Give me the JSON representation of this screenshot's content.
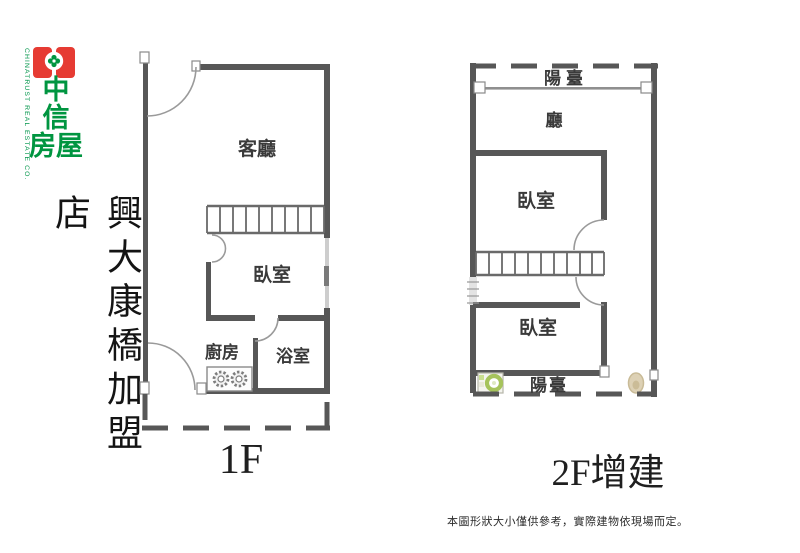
{
  "logo": {
    "company_en": "CHINATRUST REAL ESTATE CO.",
    "zh_lines": [
      "中",
      "信",
      "房屋"
    ],
    "colors": {
      "red": "#e63b33",
      "green": "#009540"
    }
  },
  "store_name": "興大康橋加盟店",
  "plans": {
    "floor1": {
      "caption": "1F",
      "labels": {
        "living": "客廳",
        "bedroom": "臥室",
        "kitchen": "廚房",
        "bath": "浴室"
      }
    },
    "floor2": {
      "caption": "2F增建",
      "labels": {
        "balcony_top": "陽臺",
        "hall": "廳",
        "bedroom_upper": "臥室",
        "bedroom_lower": "臥室",
        "balcony_bottom": "陽臺"
      }
    }
  },
  "disclaimer": "本圖形狀大小僅供參考，實際建物依現場而定。",
  "colors": {
    "wall": "#575757",
    "thin_line": "#9a9a9a",
    "window": "#cdcdcd",
    "washer_green": "#a6c35c",
    "toilet_tan": "#ddd1b5",
    "text": "#1f1f1f"
  }
}
